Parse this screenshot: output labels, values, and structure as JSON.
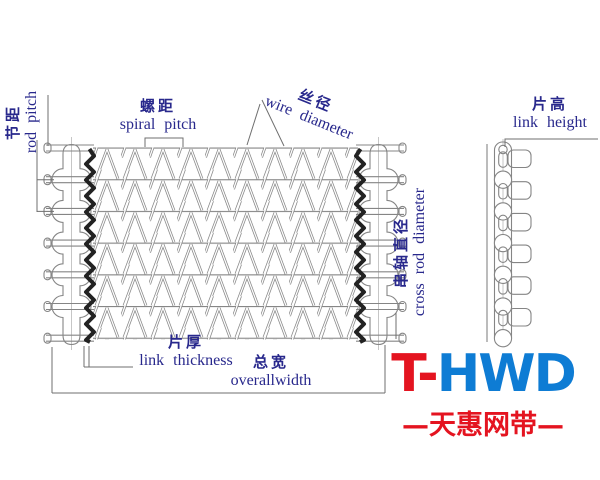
{
  "title": "spiral wire mesh belt dimension diagram",
  "labels": {
    "rod_pitch": {
      "zh": "节距",
      "en": "rod pitch"
    },
    "spiral_pitch": {
      "zh": "螺距",
      "en": "spiral pitch"
    },
    "wire_diameter": {
      "zh": "丝径",
      "en": "wire diameter"
    },
    "link_height": {
      "zh": "片高",
      "en": "link height"
    },
    "cross_rod_diameter": {
      "zh": "串轴直径",
      "en": "cross rod diameter"
    },
    "link_thickness": {
      "zh": "片厚",
      "en": "link thickness"
    },
    "overall_width": {
      "zh": "总宽",
      "en": "overallwidth"
    }
  },
  "logo": {
    "red_part": "T-",
    "blue_part": "HWD",
    "subtitle": "—天惠网带—"
  },
  "colors": {
    "label_text": "#28288C",
    "logo_red": "#E41420",
    "logo_blue": "#0E7CD4",
    "line": "#858585",
    "dark_strip": "#222222",
    "background": "#FFFFFF"
  }
}
